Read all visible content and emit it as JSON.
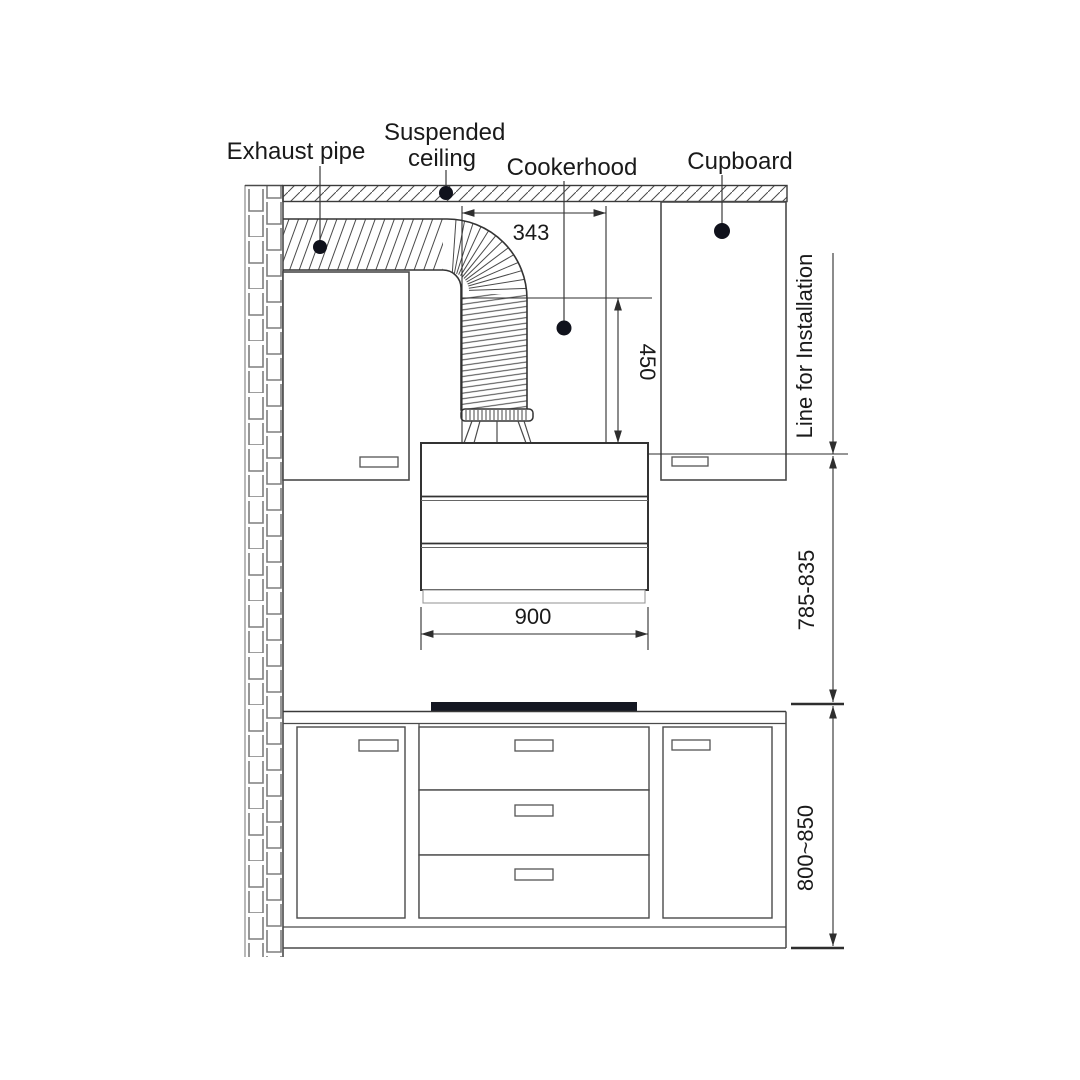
{
  "diagram": {
    "kind": "cooker-hood-installation-drawing",
    "callouts": {
      "exhaust_pipe": "Exhaust pipe",
      "suspended_ceiling": [
        "Suspended",
        "ceiling"
      ],
      "cookerhood": "Cookerhood",
      "cupboard": "Cupboard"
    },
    "dimensions": {
      "duct_offset": "343",
      "hood_clearance": "450",
      "hood_width": "900",
      "installation_line": "Line for Installation",
      "hood_bottom_to_hob": "785-835",
      "floor_to_hob": "800~850"
    },
    "colors": {
      "ink": "#333333",
      "light_line": "#8a8a8a",
      "cooktop": "#141722",
      "background": "#ffffff"
    }
  }
}
